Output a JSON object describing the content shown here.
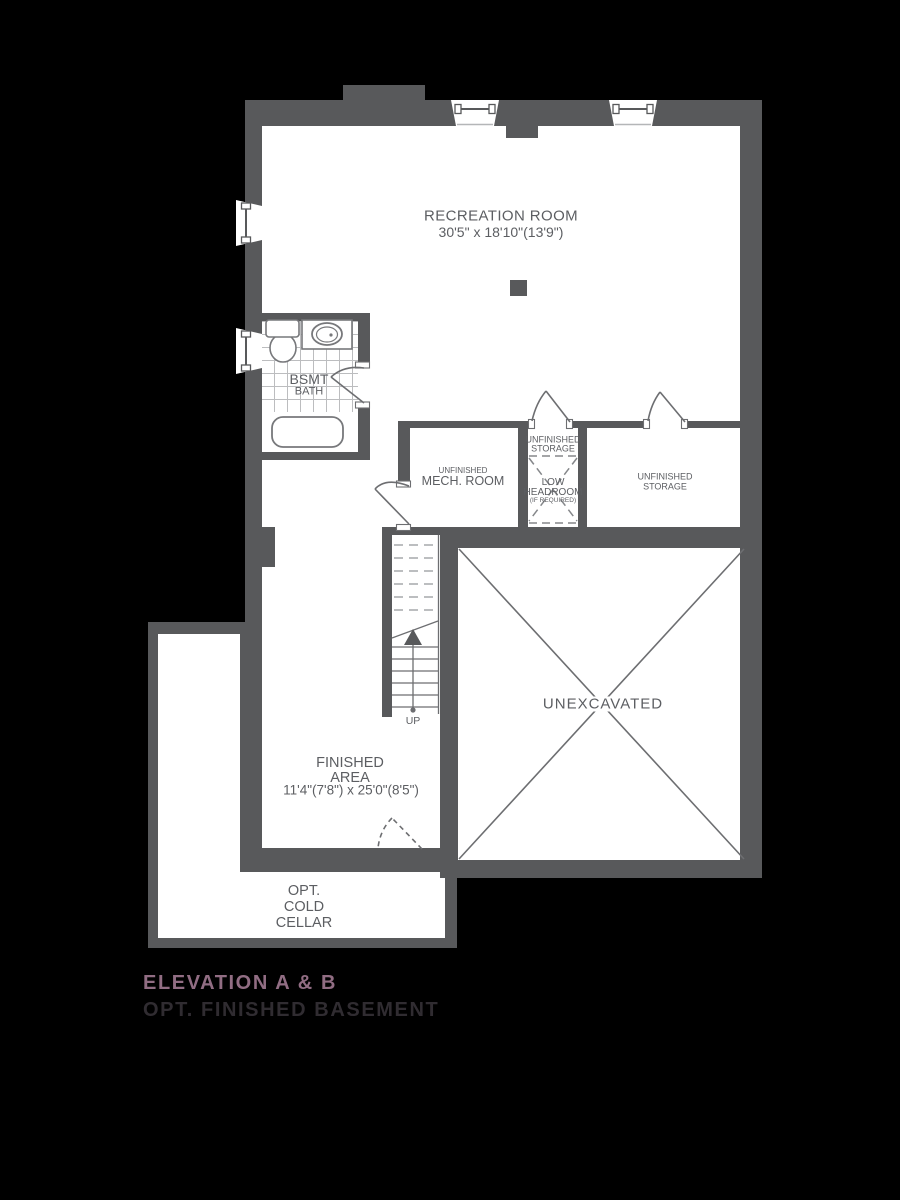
{
  "colors": {
    "background": "#000000",
    "wall": "#58595b",
    "line": "#6d6e71",
    "light_line": "#a6a8ab",
    "room_fill": "#ffffff",
    "label_text": "#5c5e62",
    "title_accent": "#916d83",
    "subtitle": "#302c31"
  },
  "rooms": {
    "recreation": {
      "name": "RECREATION ROOM",
      "dims": "30'5\" x 18'10\"(13'9\")"
    },
    "bsmt_bath": {
      "line1": "BSMT",
      "line2": "BATH"
    },
    "mech": {
      "prefix": "UNFINISHED",
      "name": "MECH. ROOM"
    },
    "storage_center": {
      "line1": "UNFINISHED",
      "line2": "STORAGE"
    },
    "low_headroom": {
      "line1": "LOW",
      "line2": "HEADROOM",
      "line3": "(IF REQUIRED)"
    },
    "storage_right": {
      "line1": "UNFINISHED",
      "line2": "STORAGE"
    },
    "unexcavated": {
      "name": "UNEXCAVATED"
    },
    "stairs": {
      "direction": "UP"
    },
    "finished_area": {
      "line1": "FINISHED",
      "line2": "AREA",
      "dims": "11'4\"(7'8\") x 25'0\"(8'5\")"
    },
    "cold_cellar": {
      "line1": "OPT.",
      "line2": "COLD",
      "line3": "CELLAR"
    }
  },
  "title": {
    "line1": "ELEVATION A & B",
    "line2": "OPT. FINISHED BASEMENT"
  }
}
